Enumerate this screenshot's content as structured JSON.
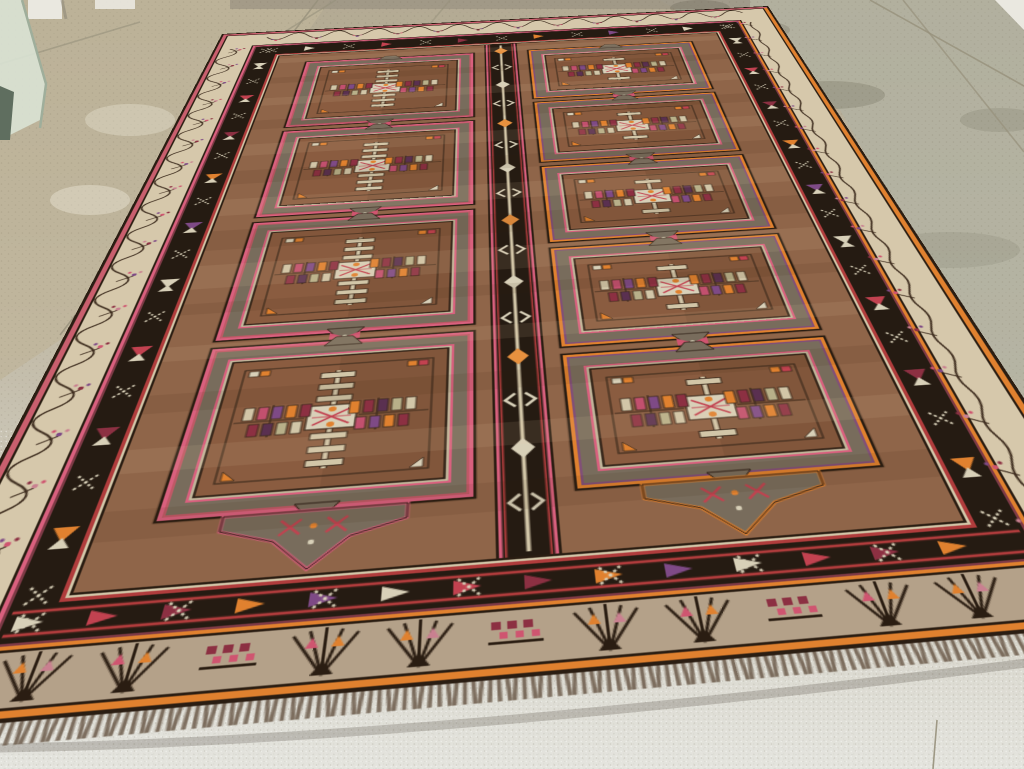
{
  "photo": {
    "subject": "tribal antique gallery carpet with two columns of ladder-pole cartouche panels, photographed in perspective on a showroom tile floor",
    "environment": "speckled stone tile floor, white baseboard wall and glass panel at upper left, white wall sliver at upper right",
    "floor": {
      "base_top": "#b3aa93",
      "base_mid": "#c2bba8",
      "base_bottom": "#e4e4de",
      "left_tint": "#bfb499",
      "right_tint": "#b2b1a1",
      "grout": "#97917c",
      "wall": "#eae8e0",
      "wall_shadow": "#8f897a",
      "glass": "#d9e2d4",
      "glass_edge": "#9fae9b",
      "glass_dark": "#5f6e5f",
      "smudge": "#5a5846",
      "stain": "#efeadb",
      "speck_dark": "#6e6450",
      "speck_light": "#ffffff",
      "shadow": "#3c332a",
      "top_strip": "#9a9181"
    },
    "rug": {
      "field": "#8f6549",
      "panelField": "#8a5c40",
      "gray": "#786c5c",
      "black": "#251b12",
      "outline": "#2a1d12",
      "darkLine": "#3c2b1d",
      "ivoryBand": "#d6c8ab",
      "fanBand": "#b4a189",
      "ivory": "#d2c6a8",
      "ivoryBright": "#d8d0b8",
      "pink": "#d9607e",
      "rose": "#c98090",
      "magenta": "#cf5570",
      "pinkEdge": "#c95f6e",
      "red": "#b03c3c",
      "deepRed": "#c24250",
      "maroon": "#8c3042",
      "maroonLine": "#7e3a46",
      "orange": "#e0812f",
      "orangeBright": "#e8913f",
      "purple": "#7e4a86",
      "aubergine": "#5a3050",
      "fringe": "#6b5a49",
      "columns": [
        {
          "side": "left",
          "panels": 4,
          "accent": "#d9607e",
          "accent2": "#cf5570"
        },
        {
          "side": "right",
          "panels": 5,
          "accent": "#e0812f",
          "accent2": "#7e4a86"
        }
      ],
      "center_band": {
        "motifs": [
          "orange-diamond",
          "ivory-chevron-pair",
          "ivory-diamond"
        ],
        "repeats": 16
      },
      "borders": {
        "side_band": "ivory vine meander with small blossoms",
        "side_inner_band": "black with dotted X motifs and colored triangles",
        "near_band": "tan with radiating fan motifs and floral clusters",
        "fan_repeats": 11,
        "edge_stripe_near": "orange",
        "edge_stripe_far": "pink-red"
      },
      "pendants": 2,
      "tile_colors": [
        "#d2c6a8",
        "#c2506e",
        "#7e4a86",
        "#e0812f",
        "#8c3042",
        "#5a3050",
        "#b8b089"
      ]
    }
  }
}
